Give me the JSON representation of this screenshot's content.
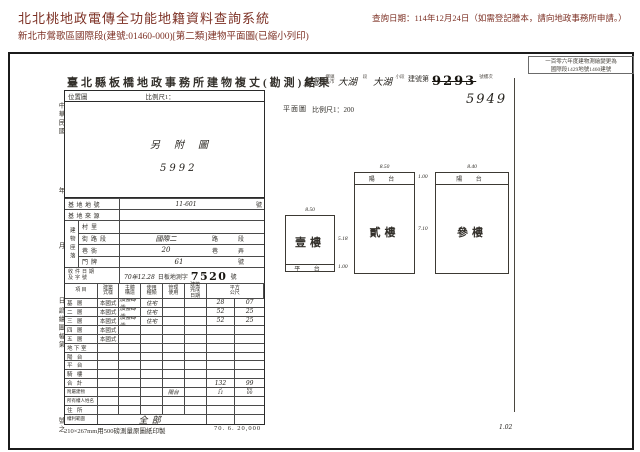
{
  "colors": {
    "header_text": "#7d3125",
    "ink": "#33302b",
    "stamp": "#17140f"
  },
  "header": {
    "system_title": "北北桃地政電傳全功能地籍資料查詢系統",
    "query_date": "查詢日期：114年12月24日（如需登記謄本，請向地政事務所申請。）",
    "subtitle": "新北市鶯歌區國際段(建號:01460-000)[第二類]建物平面圖(已縮小列印)"
  },
  "document": {
    "remark_line1": "一百零六年度建物測繪變更為",
    "remark_line2": "國際段1429地號1460建號",
    "title": "臺北縣板橋地政事務所建物複丈(勘測)結果",
    "building_header": {
      "township_value": "鶯歌",
      "township_label": "鄉鎮區市",
      "section_value": "大湖",
      "section_label": "段",
      "subsection_value": "大湖",
      "subsection_label": "小段",
      "building_no_prefix": "建號第",
      "building_no_old": "9293",
      "building_no_new": "5949",
      "building_no_suffix": "號樓次"
    },
    "location_map": {
      "label": "位置圖",
      "scale_label": "比例尺1：",
      "note": "另附圖",
      "sheet_no": "5992"
    },
    "plan_header": {
      "label": "平面圖",
      "scale_label": "比例尺1：200"
    },
    "margin_notes": [
      "中華民國",
      "年",
      "月",
      "日",
      "調繪圖幅第",
      "號之"
    ],
    "site_rows": [
      {
        "label": "基地地號",
        "value": "11-601",
        "suffix": "號"
      },
      {
        "label": "基地來源",
        "value": "",
        "suffix": ""
      }
    ],
    "site_group": {
      "label": "建物座落",
      "rows": [
        {
          "label": "村里",
          "value": "",
          "units": []
        },
        {
          "label": "街路段",
          "value": "國際二",
          "units": [
            "路",
            "段"
          ]
        },
        {
          "label": "巷衖",
          "value": "20",
          "units": [
            "巷",
            "弄"
          ]
        },
        {
          "label": "門牌",
          "value": "61",
          "units": [
            "號"
          ]
        }
      ]
    },
    "receipt": {
      "label_line1": "收件日期",
      "label_line2": "及字號",
      "date": "70年12.28",
      "office_text": "日板地測字",
      "number": "7520",
      "suffix": "號"
    },
    "main_table": {
      "headers": [
        "項 目",
        "建築式樣",
        "主體構造",
        "使用種類",
        "管理使用",
        "建築完成日期",
        "平方公尺"
      ],
      "rows": [
        {
          "item": "基 層",
          "style": "本國式",
          "structure": "加強磚造",
          "use": "住宅",
          "sqm": [
            "28",
            "07"
          ]
        },
        {
          "item": "二 層",
          "style": "本國式",
          "structure": "加強磚造",
          "use": "住宅",
          "sqm": [
            "52",
            "25"
          ]
        },
        {
          "item": "三 層",
          "style": "本國式",
          "structure": "加強磚造",
          "use": "住宅",
          "sqm": [
            "52",
            "25"
          ]
        },
        {
          "item": "四 層",
          "style": "本國式",
          "structure": "",
          "use": "",
          "sqm": []
        },
        {
          "item": "五 層",
          "style": "本國式",
          "structure": "",
          "use": "",
          "sqm": []
        },
        {
          "item": "地下室",
          "style": "",
          "structure": "",
          "use": "",
          "sqm": []
        },
        {
          "item": "陽 台",
          "style": "",
          "structure": "",
          "use": "",
          "sqm": []
        },
        {
          "item": "平 台",
          "style": "",
          "structure": "",
          "use": "",
          "sqm": []
        },
        {
          "item": "騎 樓",
          "style": "",
          "structure": "",
          "use": "",
          "sqm": []
        },
        {
          "item": "合 計",
          "style": "",
          "structure": "",
          "use": "",
          "sqm": [
            "132",
            "99"
          ]
        },
        {
          "item": "附屬建物",
          "hand_note": "陽台",
          "style": "",
          "structure": "",
          "use": "",
          "sqm": [
            "5",
            "60"
          ],
          "sqm2": [
            "11",
            "00"
          ]
        },
        {
          "item": "所有權人姓名",
          "style": "",
          "structure": "",
          "use": "",
          "sqm": []
        },
        {
          "item": "住 所",
          "style": "",
          "structure": "",
          "use": "",
          "sqm": []
        },
        {
          "item": "權利範圍",
          "wide_value": "全部",
          "style": "",
          "structure": "",
          "use": "",
          "sqm": []
        }
      ]
    },
    "footer_left": "210×267mm用500磅測量原圖紙印製",
    "footer_right": "70. 6. 20,000",
    "plans": [
      {
        "name": "壹樓",
        "width_dim": "8.50",
        "height_dim": "5.18",
        "strip_label": "平 台",
        "strip_dim": "1.00",
        "strip_pos": "bottom"
      },
      {
        "name": "貳樓",
        "width_dim": "8.50",
        "height_dim": "7.10",
        "strip_label": "陽 台",
        "strip_dim": "1.00",
        "strip_pos": "top"
      },
      {
        "name": "參樓",
        "width_dim": "8.40",
        "height_dim": "",
        "strip_label": "陽 台",
        "strip_dim": "",
        "strip_pos": "top"
      }
    ],
    "corner_note": "1.02"
  }
}
